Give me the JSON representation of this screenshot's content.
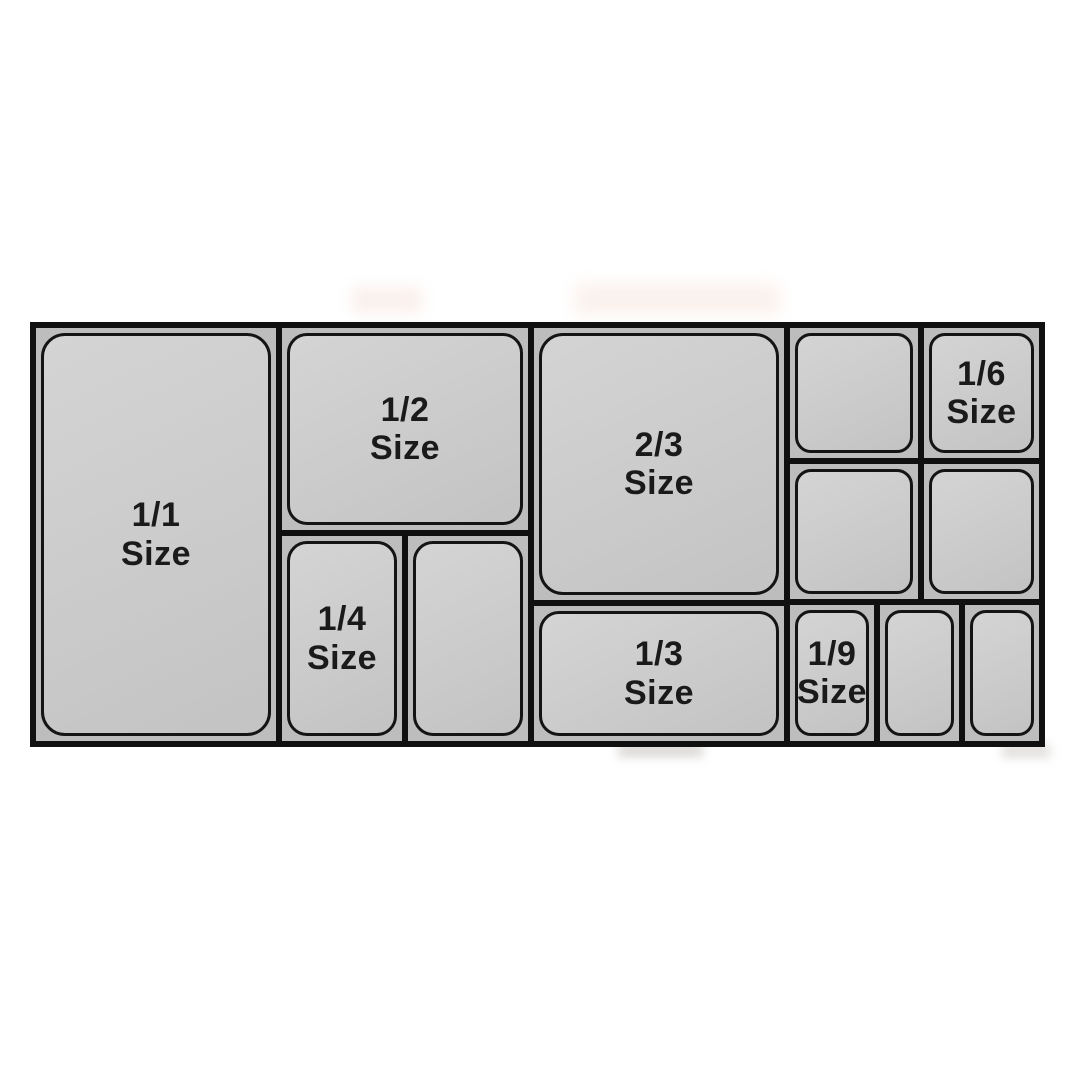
{
  "colors": {
    "page_background": "#ffffff",
    "grid_lines": "#101010",
    "cell_background": "#bdbdbd",
    "pan_fill": "#cbcbcb",
    "pan_outline": "#141414",
    "label_text": "#1a1a1a"
  },
  "pans": {
    "full": {
      "fraction": "1/1",
      "word": "Size"
    },
    "half": {
      "fraction": "1/2",
      "word": "Size"
    },
    "two_thirds": {
      "fraction": "2/3",
      "word": "Size"
    },
    "quarter": {
      "fraction": "1/4",
      "word": "Size"
    },
    "third": {
      "fraction": "1/3",
      "word": "Size"
    },
    "sixth": {
      "fraction": "1/6",
      "word": "Size"
    },
    "ninth": {
      "fraction": "1/9",
      "word": "Size"
    }
  }
}
